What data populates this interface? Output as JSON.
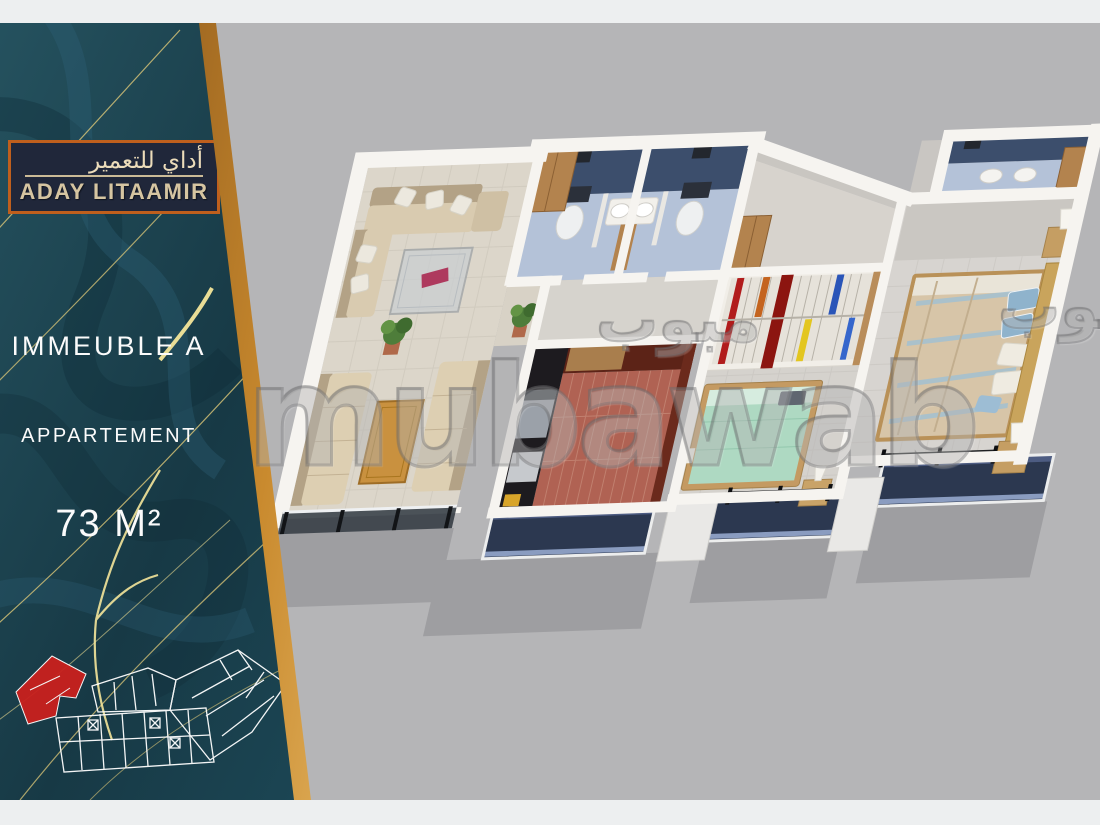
{
  "sidebar": {
    "logo": {
      "arabic": "أداي للتعمير",
      "latin": "ADAY LITAAMIR",
      "border_color": "#bf5f1d",
      "background": "#20273a",
      "text_color": "#d6c5a1"
    },
    "labels": {
      "building": "IMMEUBLE A",
      "unit_type": "APPARTEMENT",
      "area": "73 M²"
    },
    "panel_color": "#1b4050",
    "gold_edge_color": "#e7c97c",
    "minimap": {
      "line_color": "#ffffff",
      "highlight_color": "#c9201d"
    }
  },
  "watermark": {
    "latin": "mubawab",
    "arabic": "مبوب"
  },
  "page": {
    "background": "#b5b5b7",
    "band_color": "#edeff0"
  },
  "floorplan_palette": {
    "wall_white": "#f6f4f0",
    "bath_navy": "#3c4e6c",
    "bath_floor_blue": "#b4c2d8",
    "kitchen_brick": "#b06253",
    "kitchen_wall_maroon": "#5c2317",
    "counter_black": "#1d1b1f",
    "living_tile": "#dcd6ca",
    "sofa_beige": "#d9cbb0",
    "wood": "#b3834e",
    "mint_bed": "#aed9c2",
    "master_duvet": "#d7c5a8",
    "balcony_navy": "#2c3850",
    "slab_gray": "#9e9ea1"
  }
}
